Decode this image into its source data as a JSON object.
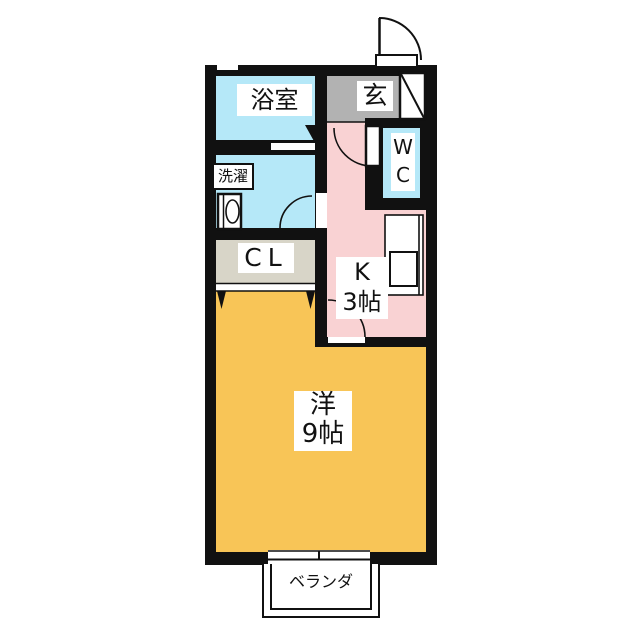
{
  "floorplan": {
    "wall_color": "#111111",
    "rooms": {
      "bathroom": {
        "label": "浴室",
        "color": "#b5e8f8"
      },
      "entrance": {
        "label": "玄",
        "color": "#b2b2b2"
      },
      "wc": {
        "label": "W\nC",
        "color": "#b5e8f8"
      },
      "washroom": {
        "laundry_label": "洗濯",
        "color": "#b5e8f8"
      },
      "closet": {
        "label": "CL",
        "color": "#d8d5c8"
      },
      "kitchen": {
        "label": "K\n3帖",
        "color": "#f9d2d3"
      },
      "western_room": {
        "label": "洋\n9帖",
        "color": "#f8c557"
      },
      "veranda": {
        "label": "ベランダ",
        "color": "#ffffff"
      }
    },
    "fixtures": {
      "entrance_door": "entrance-swing-door",
      "shoe_cabinet": "shoe-cabinet-diagonal",
      "wc_door": "wc-swing-door",
      "bath_door": "bath-folding-door-mark",
      "washroom_door": "washroom-swing-door",
      "kitchen_door": "kitchen-swing-door",
      "closet_door": "closet-folding-door-marks",
      "washing_machine": "washing-machine-pan",
      "kitchen_counter": "counter-with-sink",
      "window_bottom": "sliding-window",
      "window_bath": "bath-vent-window"
    }
  }
}
